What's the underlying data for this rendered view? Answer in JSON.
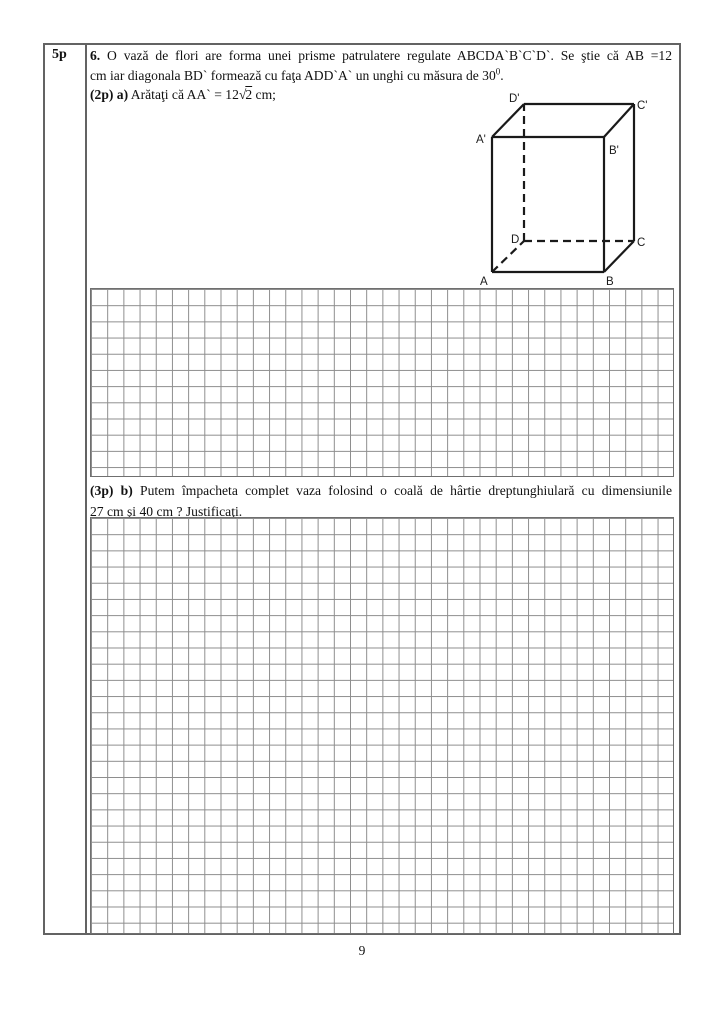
{
  "table": {
    "points_label": "5p"
  },
  "problem": {
    "number": "6.",
    "line1": "O vază de flori are forma unei prisme patrulatere regulate ABCDA`B`C`D`. Se ştie că AB =12",
    "line2_main": "cm iar  diagonala BD` formează cu faţa ADD`A` un unghi cu măsura de 30",
    "line2_sup": "0",
    "line2_period": ".",
    "part_a": {
      "label": "(2p) a)",
      "text_before_sqrt": "Arătaţi că AA` = 12",
      "sqrt_sign": "√",
      "radicand": "2",
      "text_after_sqrt": " cm;"
    },
    "part_b": {
      "label": "(3p) b)",
      "line1": "Putem împacheta complet vaza folosind o coală de hârtie dreptunghiulară cu dimensiunile",
      "line2": "27 cm şi 40 cm ? Justificaţi."
    }
  },
  "figure": {
    "description": "regular quadrilateral prism ABCDA'B'C'D'",
    "labels": {
      "A": "A",
      "B": "B",
      "C": "C",
      "D": "D",
      "A_prime": "A'",
      "B_prime": "B'",
      "C_prime": "C'",
      "D_prime": "D'"
    }
  },
  "page": {
    "number": "9"
  },
  "colors": {
    "table_border": "#636363",
    "grid_line": "#8d8d8d",
    "text": "#111111",
    "figure_stroke": "#1a1a1a"
  }
}
